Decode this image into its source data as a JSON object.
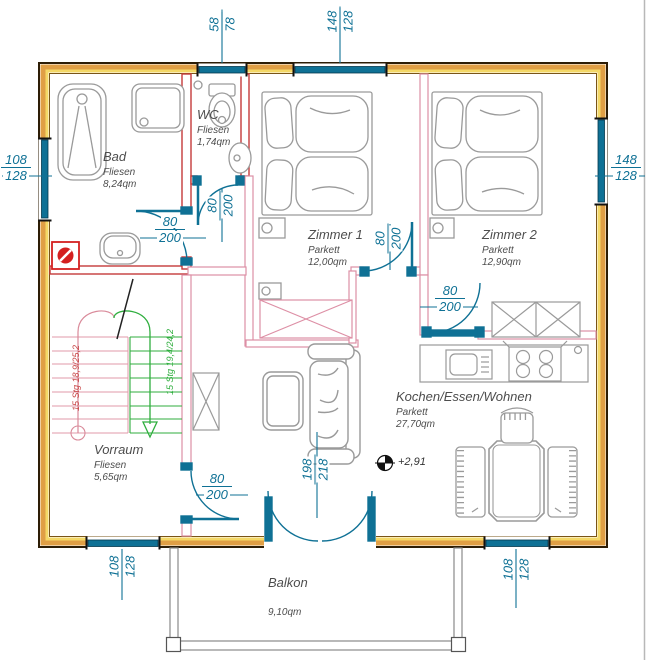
{
  "rooms": {
    "bad": {
      "name": "Bad",
      "floor": "Fliesen",
      "area": "8,24qm"
    },
    "wc": {
      "name": "WC",
      "floor": "Fliesen",
      "area": "1,74qm"
    },
    "zimmer1": {
      "name": "Zimmer 1",
      "floor": "Parkett",
      "area": "12,00qm"
    },
    "zimmer2": {
      "name": "Zimmer 2",
      "floor": "Parkett",
      "area": "12,90qm"
    },
    "wohnen": {
      "name": "Kochen/Essen/Wohnen",
      "floor": "Parkett",
      "area": "27,70qm"
    },
    "vorraum": {
      "name": "Vorraum",
      "floor": "Fliesen",
      "area": "5,65qm"
    },
    "balkon": {
      "name": "Balkon",
      "area": "9,10qm"
    }
  },
  "windows": {
    "top_left": {
      "w": "58",
      "h": "78"
    },
    "top_right": {
      "w": "148",
      "h": "128"
    },
    "left": {
      "w": "108",
      "h": "128"
    },
    "right": {
      "w": "148",
      "h": "128"
    },
    "bottom_left": {
      "w": "108",
      "h": "128"
    },
    "bottom_right": {
      "w": "108",
      "h": "128"
    }
  },
  "doors": {
    "bad": {
      "w": "80",
      "h": "200"
    },
    "wc": {
      "w": "80",
      "h": "200"
    },
    "zimmer1": {
      "w": "80",
      "h": "200"
    },
    "zimmer2": {
      "w": "80",
      "h": "200"
    },
    "vorraum": {
      "w": "80",
      "h": "200"
    },
    "balcony": {
      "w": "198",
      "h": "218"
    }
  },
  "stairs": {
    "flight_up_label": "15 Stg 18,9/25,2",
    "flight_down_label": "15 Stg 19,4/24,2"
  },
  "elevation": "+2,91",
  "colors": {
    "wall_fill": "#e09f45",
    "wall_inner": "#f4d867",
    "window": "#0f7195",
    "dimension": "#0f7195",
    "partition_pink": "#dd8fa5",
    "partition_red": "#c53a3a",
    "stairs_up": "#d06a6a",
    "stairs_down": "#2fae3e",
    "furniture": "#9a9a9a"
  }
}
